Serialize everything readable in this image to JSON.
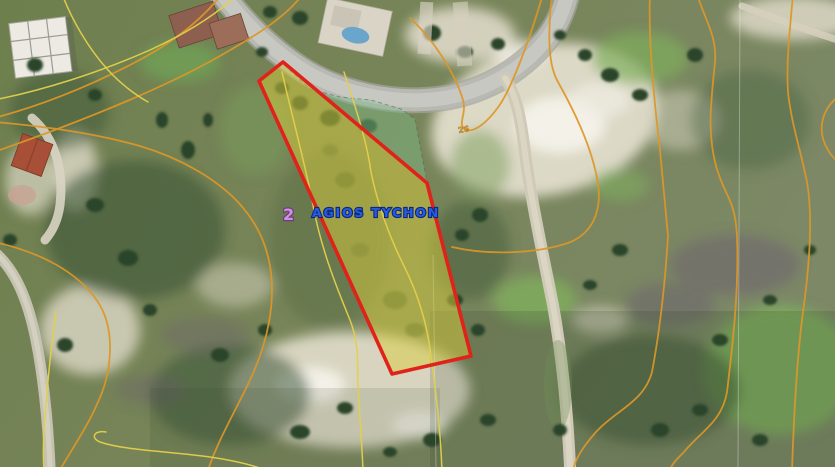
{
  "map": {
    "type": "satellite-imagery-with-cadastral-overlay",
    "place_label": {
      "text": "AGIOS TYCHON",
      "color": "#2a5ae0"
    },
    "marker_label": {
      "text": "2",
      "color": "#d290e2"
    },
    "contour_label": {
      "text": "26",
      "color": "#d8962a"
    },
    "parcel": {
      "points": "283,62 259,81 392,374 471,356 427,183",
      "outline_color": "#e0231a",
      "fill_color": "#d8cb3c",
      "fill_opacity": "0.5"
    },
    "adjacent_overlay": {
      "points": "284,65 310,89 340,97 371,100 401,109 415,119 427,182",
      "fill_color": "#7fbf8a",
      "fill_opacity": "0.42"
    },
    "contour_colors": {
      "major": "#dd9728",
      "minor": "#e4d04b"
    }
  }
}
